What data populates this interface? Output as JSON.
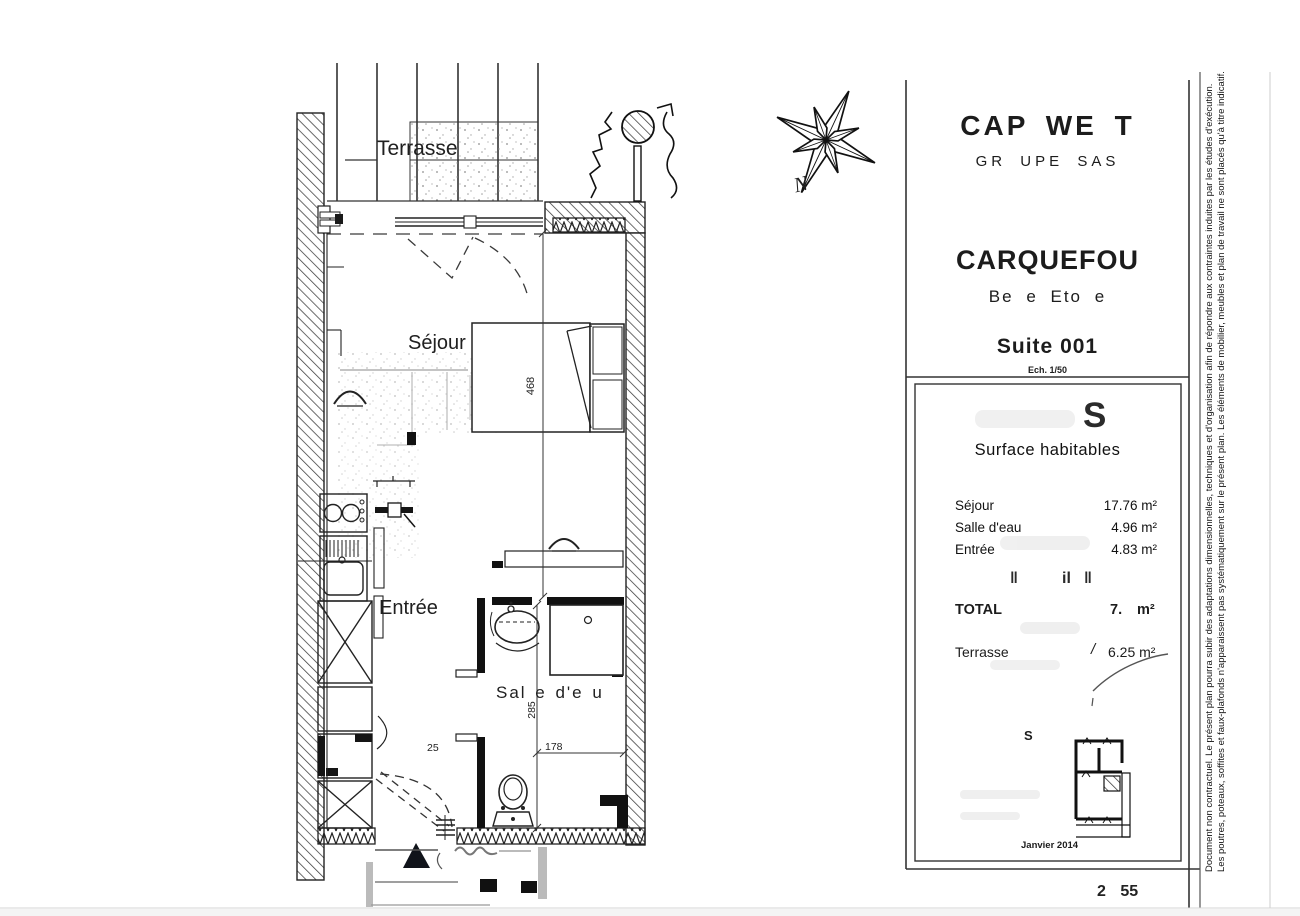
{
  "page": {
    "bottom_number": "2 55"
  },
  "title_block": {
    "company": "CAP WE T",
    "company_sub": "GR UPE SAS",
    "project": "CARQUEFOU",
    "project_sub": "Be e Eto e",
    "suite": "Suite 001",
    "scale": "Ech. 1/50",
    "surface": {
      "ghost_letter": "S",
      "heading": "Surface habitables",
      "rows": [
        {
          "label": "Séjour",
          "value": "17.76 m²"
        },
        {
          "label": "Salle d'eau",
          "value": "4.96 m²"
        },
        {
          "label": "Entrée",
          "value": "4.83 m²"
        }
      ],
      "faded_marks": [
        "‖",
        "il",
        "‖"
      ],
      "total_label": "TOTAL",
      "total_value": "7.",
      "total_unit": "m²",
      "terrace_label": "Terrasse",
      "terrace_prefix": "/",
      "terrace_value": "6.25 m²",
      "keyplan_label": "S",
      "date": "Janvier 2014"
    }
  },
  "plan": {
    "labels": {
      "terrasse": "Terrasse",
      "sejour": "Séjour",
      "entree": "Entrée",
      "salle_deau": "Sal e d'e u"
    },
    "dimensions": {
      "sejour_height": "468",
      "bath_height": "285",
      "door": "25",
      "bath_width": "178"
    },
    "compass_label": "N"
  },
  "disclaimer": {
    "line1": "Document non contractuel. Le présent plan pourra subir des adaptations dimensionnelles, techniques et d'organisation afin de répondre aux contraintes induites par les études d'exécution.",
    "line2": "Les poutres, poteaux, soffites et faux-plafonds n'apparaissent pas systématiquement sur le présent plan. Les éléments de mobilier, meubles et plan de travail ne sont placés qu'à titre indicatif."
  },
  "colors": {
    "ink": "#1c1c1c",
    "paper": "#ffffff",
    "light_gray": "#bbbbbb"
  }
}
